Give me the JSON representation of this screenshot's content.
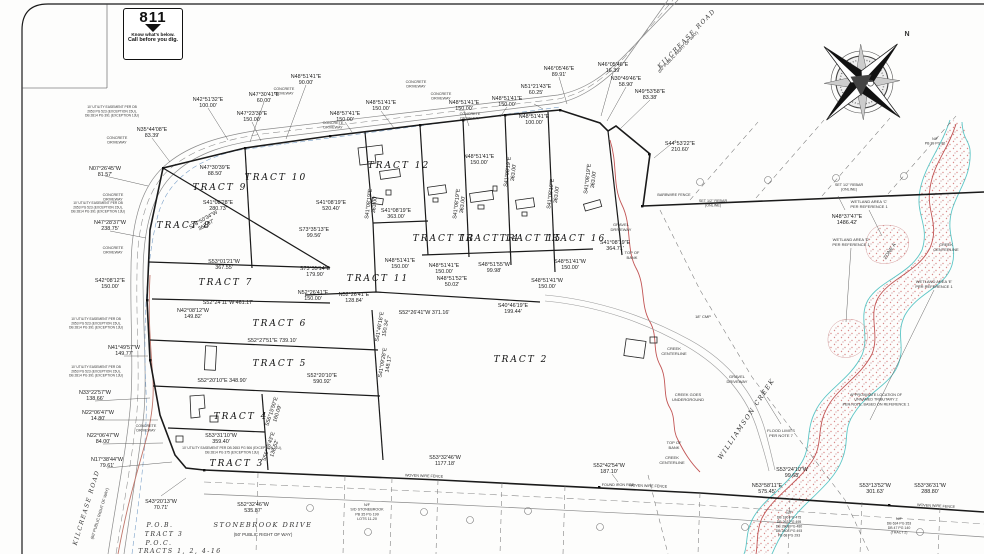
{
  "logo811": {
    "number": "811",
    "line1": "Know what's below.",
    "line2": "Call before you dig."
  },
  "compass": {
    "north": "N"
  },
  "tracts": [
    {
      "label": "TRACT 9",
      "x": 220,
      "y": 190
    },
    {
      "label": "TRACT 10",
      "x": 276,
      "y": 180
    },
    {
      "label": "TRACT 8",
      "x": 184,
      "y": 228
    },
    {
      "label": "TRACT 7",
      "x": 226,
      "y": 285
    },
    {
      "label": "TRACT 12",
      "x": 399,
      "y": 168
    },
    {
      "label": "TRACT 13",
      "x": 444,
      "y": 241
    },
    {
      "label": "TRACT 14",
      "x": 489,
      "y": 241
    },
    {
      "label": "TRACT 15",
      "x": 531,
      "y": 241
    },
    {
      "label": "TRACT 16",
      "x": 575,
      "y": 241
    },
    {
      "label": "TRACT 11",
      "x": 378,
      "y": 281
    },
    {
      "label": "TRACT 6",
      "x": 280,
      "y": 326
    },
    {
      "label": "TRACT 5",
      "x": 280,
      "y": 366
    },
    {
      "label": "TRACT 4",
      "x": 241,
      "y": 419
    },
    {
      "label": "TRACT 3",
      "x": 237,
      "y": 466
    },
    {
      "label": "TRACT 2",
      "x": 521,
      "y": 362
    }
  ],
  "bearings": [
    {
      "t": "N42°51'32\"E",
      "d": "100.00'",
      "x": 208,
      "y": 101
    },
    {
      "t": "N35°44'08\"E",
      "d": "83.39'",
      "x": 152,
      "y": 131
    },
    {
      "t": "N47°30'41\"E",
      "d": "60.00'",
      "x": 264,
      "y": 96
    },
    {
      "t": "N47°23'30\"E",
      "d": "150.00'",
      "x": 252,
      "y": 115
    },
    {
      "t": "N48°51'41\"E",
      "d": "90.00'",
      "x": 306,
      "y": 78
    },
    {
      "t": "N48°57'41\"E",
      "d": "150.00'",
      "x": 345,
      "y": 115
    },
    {
      "t": "N48°51'41\"E",
      "d": "150.00'",
      "x": 381,
      "y": 104
    },
    {
      "t": "N48°51'41\"E",
      "d": "150.00'",
      "x": 464,
      "y": 104
    },
    {
      "t": "N48°51'41\"E",
      "d": "150.00'",
      "x": 507,
      "y": 100
    },
    {
      "t": "N48°51'41\"E",
      "d": "100.00'",
      "x": 534,
      "y": 118
    },
    {
      "t": "N51°21'43\"E",
      "d": "60.25'",
      "x": 536,
      "y": 88
    },
    {
      "t": "N46°05'46\"E",
      "d": "89.91'",
      "x": 559,
      "y": 70
    },
    {
      "t": "N46°05'46\"E",
      "d": "16.39'",
      "x": 613,
      "y": 66
    },
    {
      "t": "N30°49'46\"E",
      "d": "58.90'",
      "x": 626,
      "y": 80
    },
    {
      "t": "N49°53'58\"E",
      "d": "83.38'",
      "x": 650,
      "y": 93
    },
    {
      "t": "S44°53'22\"E",
      "d": "210.60'",
      "x": 680,
      "y": 145
    },
    {
      "t": "N48°37'47\"E",
      "d": "1486.42'",
      "x": 847,
      "y": 218
    },
    {
      "t": "N07°26'45\"W",
      "d": "81.57'",
      "x": 105,
      "y": 170
    },
    {
      "t": "N47°28'37\"W",
      "d": "238.75'",
      "x": 110,
      "y": 224
    },
    {
      "t": "S42°08'12\"E",
      "d": "150.00'",
      "x": 110,
      "y": 282
    },
    {
      "t": "N41°49'57\"W",
      "d": "149.77'",
      "x": 124,
      "y": 349
    },
    {
      "t": "N33°22'57\"W",
      "d": "138.66'",
      "x": 95,
      "y": 394
    },
    {
      "t": "N22°06'47\"W",
      "d": "14.80'",
      "x": 98,
      "y": 414
    },
    {
      "t": "N22°06'47\"W",
      "d": "84.00'",
      "x": 103,
      "y": 437
    },
    {
      "t": "N17°38'44\"W",
      "d": "79.61'",
      "x": 107,
      "y": 461
    },
    {
      "t": "S43°20'13\"W",
      "d": "70.71'",
      "x": 161,
      "y": 503
    },
    {
      "t": "N47°30'39\"E",
      "d": "88.50'",
      "x": 215,
      "y": 169
    },
    {
      "t": "S41°08'28\"E",
      "d": "280.73'",
      "x": 218,
      "y": 204
    },
    {
      "t": "S78°50'34\"W",
      "d": "362.97'",
      "x": 204,
      "y": 221,
      "rot": -30
    },
    {
      "t": "S41°08'19\"E",
      "d": "520.40'",
      "x": 331,
      "y": 204
    },
    {
      "t": "S73°35'13\"E",
      "d": "99.56'",
      "x": 314,
      "y": 231
    },
    {
      "t": "S53°01'21\"W",
      "d": "367.55'",
      "x": 224,
      "y": 263
    },
    {
      "t": "S73°35'14\"E",
      "d": "179.90'",
      "x": 315,
      "y": 270
    },
    {
      "t": "S52°24'11\"W  461.17'",
      "d": "",
      "x": 228,
      "y": 304,
      "inline": true
    },
    {
      "t": "N42°08'12\"W",
      "d": "149.82'",
      "x": 193,
      "y": 312
    },
    {
      "t": "S52°27'51\"E  739.10'",
      "d": "",
      "x": 272,
      "y": 342,
      "inline": true
    },
    {
      "t": "S52°20'10\"E  348.90'",
      "d": "",
      "x": 222,
      "y": 382,
      "inline": true
    },
    {
      "t": "S52°20'10\"E",
      "d": "590.92'",
      "x": 322,
      "y": 377
    },
    {
      "t": "S53°31'10\"W",
      "d": "359.40'",
      "x": 221,
      "y": 437
    },
    {
      "t": "S56°15'50\"E",
      "d": "160.09'",
      "x": 273,
      "y": 412,
      "rot": -72
    },
    {
      "t": "S56°15'43\"E",
      "d": "138.52'",
      "x": 270,
      "y": 447,
      "rot": -72
    },
    {
      "t": "S52°32'46\"W",
      "d": "535.87'",
      "x": 253,
      "y": 506
    },
    {
      "t": "S41°08'19\"E",
      "d": "363.00'",
      "x": 370,
      "y": 204,
      "rot": -83
    },
    {
      "t": "S41°08'19\"E",
      "d": "363.00'",
      "x": 396,
      "y": 212
    },
    {
      "t": "S41°08'19\"E",
      "d": "363.00'",
      "x": 458,
      "y": 204,
      "rot": -83
    },
    {
      "t": "S41°08'19\"E",
      "d": "363.00'",
      "x": 509,
      "y": 172,
      "rot": -83
    },
    {
      "t": "S41°08'19\"E",
      "d": "363.00'",
      "x": 552,
      "y": 194,
      "rot": -83
    },
    {
      "t": "S41°08'19\"E",
      "d": "363.00'",
      "x": 589,
      "y": 179,
      "rot": -83
    },
    {
      "t": "N48°51'41\"E",
      "d": "150.00'",
      "x": 479,
      "y": 158
    },
    {
      "t": "N48°51'41\"E",
      "d": "150.00'",
      "x": 400,
      "y": 262
    },
    {
      "t": "N48°51'41\"E",
      "d": "150.00'",
      "x": 444,
      "y": 267
    },
    {
      "t": "N48°51'52\"E",
      "d": "50.02'",
      "x": 452,
      "y": 280
    },
    {
      "t": "S48°51'55\"W",
      "d": "99.98'",
      "x": 494,
      "y": 266
    },
    {
      "t": "S48°51'41\"W",
      "d": "150.00'",
      "x": 547,
      "y": 282
    },
    {
      "t": "S48°51'41\"W",
      "d": "150.00'",
      "x": 570,
      "y": 263
    },
    {
      "t": "S41°08'19\"E",
      "d": "364.71'",
      "x": 615,
      "y": 244
    },
    {
      "t": "N52°26'41\"E",
      "d": "150.00'",
      "x": 313,
      "y": 294
    },
    {
      "t": "N52°26'41\"E",
      "d": "128.84'",
      "x": 354,
      "y": 296
    },
    {
      "t": "S52°26'41\"W  371.16'",
      "d": "",
      "x": 424,
      "y": 314,
      "inline": true
    },
    {
      "t": "S40°46'19\"E",
      "d": "199.44'",
      "x": 513,
      "y": 307
    },
    {
      "t": "S41°46'16\"E",
      "d": "150.34'",
      "x": 381,
      "y": 327,
      "rot": -80
    },
    {
      "t": "S41°09'28\"E",
      "d": "148.17'",
      "x": 384,
      "y": 363,
      "rot": -80
    },
    {
      "t": "S53°32'46\"W",
      "d": "1177.18'",
      "x": 445,
      "y": 459
    },
    {
      "t": "S52°42'54\"W",
      "d": "187.10'",
      "x": 609,
      "y": 467
    },
    {
      "t": "N53°58'11\"E",
      "d": "575.45'",
      "x": 767,
      "y": 487
    },
    {
      "t": "S53°24'10\"W",
      "d": "99.68'",
      "x": 792,
      "y": 471
    },
    {
      "t": "S53°13'52\"W",
      "d": "301.63'",
      "x": 875,
      "y": 487
    },
    {
      "t": "S53°36'31\"W",
      "d": "288.80'",
      "x": 930,
      "y": 487
    }
  ],
  "notes": [
    {
      "t": "N",
      "x": 907,
      "y": 36,
      "s": 7,
      "b": 1
    },
    {
      "t": "KILCREASE ROAD",
      "x": 688,
      "y": 40,
      "rot": -46,
      "s": 6.2,
      "cls": "crk"
    },
    {
      "t": "(60' PUBLIC RIGHT OF WAY)",
      "x": 679,
      "y": 53,
      "rot": -46,
      "s": 4.2
    },
    {
      "t": "KILCREASE ROAD",
      "x": 88,
      "y": 508,
      "rot": -73,
      "s": 6,
      "cls": "crk"
    },
    {
      "t": "(60' PUBLIC RIGHT OF WAY)",
      "x": 101,
      "y": 514,
      "rot": -73,
      "s": 4
    },
    {
      "t": "STONEBROOK DRIVE",
      "x": 263,
      "y": 527,
      "s": 6.6,
      "cls": "crk"
    },
    {
      "t": "(50' PUBLIC RIGHT OF WAY)",
      "x": 263,
      "y": 536,
      "s": 4.4
    },
    {
      "t": "P.O.B.",
      "x": 160,
      "y": 527,
      "s": 6.2,
      "cls": "crk"
    },
    {
      "t": "TRACT 3",
      "x": 164,
      "y": 536,
      "s": 6.2,
      "cls": "crk"
    },
    {
      "t": "P.O.C.",
      "x": 159,
      "y": 545,
      "s": 6.2,
      "cls": "crk"
    },
    {
      "t": "TRACTS 1, 2, 4-16",
      "x": 180,
      "y": 553,
      "s": 6.2,
      "cls": "crk"
    },
    {
      "t": "WILLIAMSON CREEK",
      "x": 748,
      "y": 420,
      "rot": -56,
      "s": 6.4,
      "cls": "crk"
    },
    {
      "t": "CREEK GOES\nUNDERGROUND",
      "x": 688,
      "y": 396,
      "s": 4
    },
    {
      "t": "TOP OF\nBANK",
      "x": 632,
      "y": 254,
      "s": 4
    },
    {
      "t": "TOP OF\nBANK",
      "x": 674,
      "y": 444,
      "s": 4
    },
    {
      "t": "CREEK\nCENTERLINE",
      "x": 672,
      "y": 459,
      "s": 4
    },
    {
      "t": "CREEK\nCENTERLINE",
      "x": 674,
      "y": 350,
      "s": 4
    },
    {
      "t": "CREEK\nCENTERLINE",
      "x": 946,
      "y": 246,
      "s": 4
    },
    {
      "t": "GRAVEL\nDRIVEWAY",
      "x": 621,
      "y": 226,
      "s": 4
    },
    {
      "t": "GRAVEL\nDRIVEWAY",
      "x": 737,
      "y": 378,
      "s": 4
    },
    {
      "t": "18\" CMP",
      "x": 703,
      "y": 318,
      "s": 4
    },
    {
      "t": "FLOOD LIMITS\nPER NOTE 7",
      "x": 781,
      "y": 432,
      "s": 4
    },
    {
      "t": "APPROXIMATE LOCATION OF\nUNNAMED TRIBUTARY 2\nPER NOTE, BASED ON REFERENCE 1",
      "x": 876,
      "y": 396,
      "s": 3.7
    },
    {
      "t": "WETLAND AREA 'C'\nPER REFERENCE 1",
      "x": 869,
      "y": 203,
      "s": 4
    },
    {
      "t": "WETLAND AREA 'D'\nPER REFERENCE 1",
      "x": 851,
      "y": 241,
      "s": 4
    },
    {
      "t": "WETLAND AREA 'E'\nPER REFERENCE 1",
      "x": 934,
      "y": 283,
      "s": 4
    },
    {
      "t": "ZONE A",
      "x": 891,
      "y": 252,
      "rot": -56,
      "s": 5
    },
    {
      "t": "BARBWIRE FENCE",
      "x": 674,
      "y": 196,
      "s": 3.7
    },
    {
      "t": "SET 1/2\" REBAR\n(ONLINE)",
      "x": 713,
      "y": 202,
      "s": 3.7
    },
    {
      "t": "SET 1/2\" REBAR\n(ONLINE)",
      "x": 849,
      "y": 186,
      "s": 3.7
    },
    {
      "t": "WOVEN WIRE FENCE",
      "x": 424,
      "y": 477,
      "rot": 2,
      "s": 3.7
    },
    {
      "t": "WOVEN WIRE FENCE",
      "x": 648,
      "y": 487,
      "rot": 2,
      "s": 3.7
    },
    {
      "t": "WOVEN WIRE FENCE",
      "x": 936,
      "y": 507,
      "rot": 3,
      "s": 3.7
    },
    {
      "t": "FOUND IRON ROD",
      "x": 618,
      "y": 486,
      "s": 3.7
    },
    {
      "t": "CONCRETE\nDRIVEWAY",
      "x": 284,
      "y": 90,
      "s": 3.7
    },
    {
      "t": "CONCRETE\nDRIVEWAY",
      "x": 333,
      "y": 124,
      "s": 3.7
    },
    {
      "t": "CONCRETE\nDRIVEWAY",
      "x": 416,
      "y": 83,
      "s": 3.7
    },
    {
      "t": "CONCRETE\nDRIVEWAY",
      "x": 441,
      "y": 95,
      "s": 3.7
    },
    {
      "t": "CONCRETE\nDRIVEWAY",
      "x": 470,
      "y": 115,
      "s": 3.7
    },
    {
      "t": "CONCRETE\nDRIVEWAY",
      "x": 117,
      "y": 139,
      "s": 3.7
    },
    {
      "t": "CONCRETE\nDRIVEWAY",
      "x": 113,
      "y": 196,
      "s": 3.7
    },
    {
      "t": "CONCRETE\nDRIVEWAY",
      "x": 113,
      "y": 249,
      "s": 3.7
    },
    {
      "t": "CONCRETE\nDRIVEWAY",
      "x": 146,
      "y": 427,
      "s": 3.7
    },
    {
      "t": "10' UTILITY EASEMENT PER DB\n2653 PG 523 (EXCEPTION 15U),\nDB 2814 PG 391 (EXCEPTION 13U)",
      "x": 112,
      "y": 108,
      "s": 3.3
    },
    {
      "t": "10' UTILITY EASEMENT PER DB\n2653 PG 523 (EXCEPTION 15U),\nDB 2814 PG 391 (EXCEPTION 13U)",
      "x": 98,
      "y": 204,
      "s": 3.3
    },
    {
      "t": "10' UTILITY EASEMENT PER DB\n2653 PG 523 (EXCEPTION 15U),\nDB 2814 PG 391 (EXCEPTION 13U)",
      "x": 96,
      "y": 320,
      "s": 3.3
    },
    {
      "t": "10' UTILITY EASEMENT PER DB\n2653 PG 523 (EXCEPTION 15U),\nDB 2814 PG 391 (EXCEPTION 13U)",
      "x": 96,
      "y": 368,
      "s": 3.3
    },
    {
      "t": "10' UTILITY EASEMENT PER DB 2653 PG 506 (EXCEPTION 11U),\nDB 2814 PG 375 (EXCEPTION 13U)",
      "x": 232,
      "y": 449,
      "s": 3.3
    },
    {
      "t": "N/F\nS/D STONEBROOK\nPB 35 PG 199\nLOTS 11-20",
      "x": 367,
      "y": 506,
      "s": 3.7
    },
    {
      "t": "N/F\nDB 180 PG 475\nDB 263 PG 495\nDB 2808 PG 480\nDB 2808 PG 493\nPB 68 PG 293",
      "x": 789,
      "y": 514,
      "s": 3.5
    },
    {
      "t": "N/F\nDB 634 PG 353\nDB 47 PG 140\n(TRACT 2)",
      "x": 899,
      "y": 520,
      "s": 3.5
    },
    {
      "t": "N/F\nPB 29 PG 80",
      "x": 935,
      "y": 140,
      "s": 3.5
    }
  ]
}
